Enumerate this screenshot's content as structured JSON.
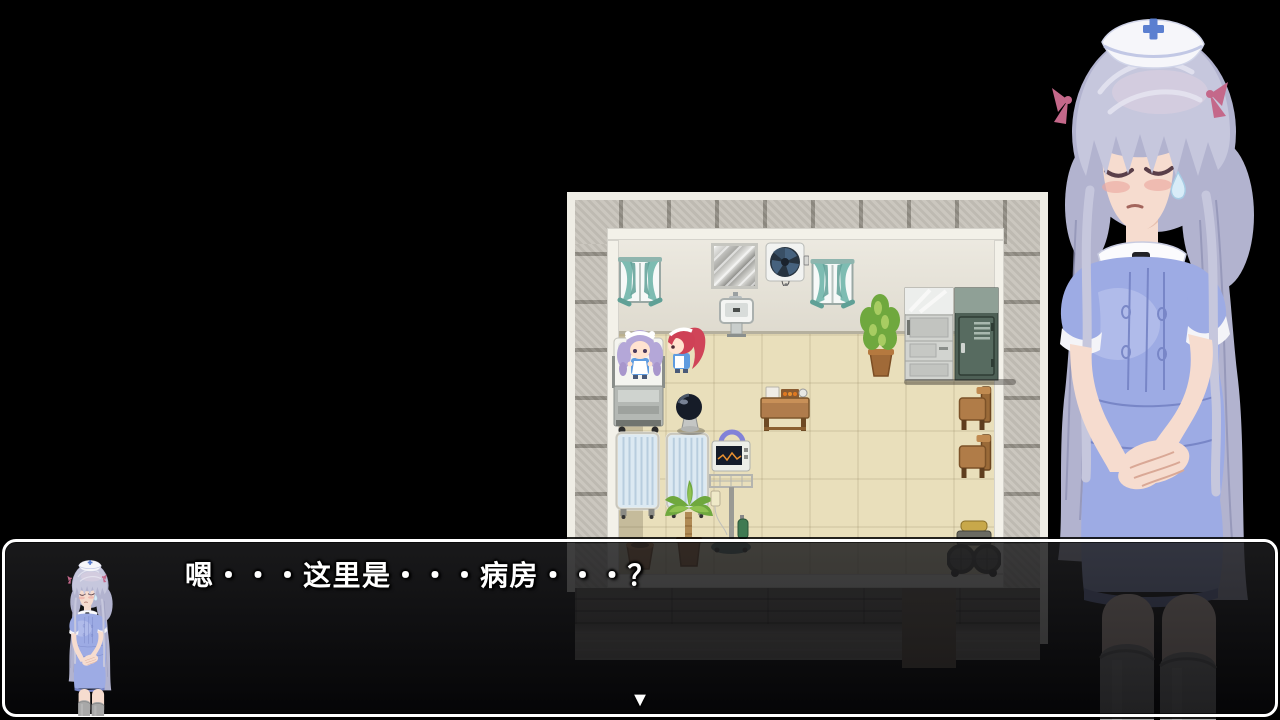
{
  "dialogue": {
    "text": "嗯・・・这里是・・・病房・・・？",
    "continue_indicator": "▼"
  },
  "colors": {
    "floor": "#e9dfbb",
    "wall_face": "#e6e2d6",
    "tile": "#c8c4bb",
    "curtain": "#7dbcb2",
    "locker_green": "#4e6056",
    "dress": "#9dabe4",
    "dress_shade": "#7583c4",
    "hair": "#b2b3cf",
    "hair_light": "#c6c7dd",
    "skin": "#f6dccf",
    "cap_cross": "#5b7fd0",
    "ribbon": "#c4688a",
    "stocking": "#a8a8a8",
    "dialog_border": "#ffffff",
    "text": "#ffffff"
  }
}
